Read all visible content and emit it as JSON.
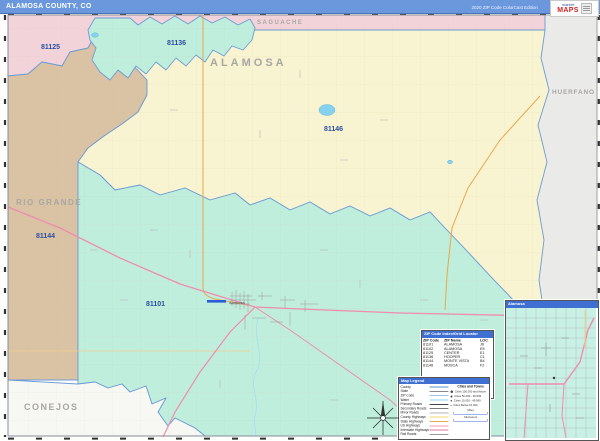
{
  "header": {
    "title": "ALAMOSA COUNTY, CO",
    "edition": "2020 ZIP Code ColorCast Edition",
    "logo": {
      "word1": "market",
      "word2": "MAPS"
    }
  },
  "map": {
    "county_labels": [
      {
        "name": "SAGUACHE"
      },
      {
        "name": "ALAMOSA"
      },
      {
        "name": "RIO GRANDE"
      },
      {
        "name": "CONEJOS"
      },
      {
        "name": "HUERFANO"
      }
    ],
    "zip_labels": [
      {
        "code": "81125"
      },
      {
        "code": "81136"
      },
      {
        "code": "81146"
      },
      {
        "code": "81144"
      },
      {
        "code": "81101"
      }
    ],
    "city_label": "Alamosa",
    "colors": {
      "zip_teal": "#bfeedd",
      "zip_yellow": "#f8f3d1",
      "zip_pink": "#f3d3da",
      "zip_tan": "#d9c3a4",
      "neighbor_gray": "#eaeae8",
      "boundary_blue": "#6d9bd3",
      "us_highway_pink": "#f08cae",
      "state_highway_orange": "#e8a84c",
      "water_blue": "#86d2ee",
      "header_blue": "#6b97dd",
      "panel_blue": "#3e6fd1"
    }
  },
  "index_table": {
    "title": "ZIP Code Index/Grid Locator",
    "columns": [
      "ZIP Code",
      "ZIP Name",
      "LOC"
    ],
    "rows": [
      {
        "zip": "81101",
        "name": "ALAMOSA",
        "loc": "J6"
      },
      {
        "zip": "81102",
        "name": "ALAMOSA",
        "loc": "E5"
      },
      {
        "zip": "81125",
        "name": "CENTER",
        "loc": "E1"
      },
      {
        "zip": "81136",
        "name": "HOOPER",
        "loc": "C1"
      },
      {
        "zip": "81144",
        "name": "MONTE VISTA",
        "loc": "B4"
      },
      {
        "zip": "81146",
        "name": "MOSCA",
        "loc": "F2"
      }
    ]
  },
  "legend": {
    "title": "Map Legend",
    "line_items": [
      {
        "label": "County",
        "color": "#5b8fd0"
      },
      {
        "label": "State",
        "color": "#8a8a8a"
      },
      {
        "label": "ZIP Code",
        "color": "#9fc4e8"
      },
      {
        "label": "Water",
        "color": "#8fd6f0"
      },
      {
        "label": "Primary Roads",
        "color": "#444444"
      },
      {
        "label": "Secondary Roads",
        "color": "#7a7a7a"
      },
      {
        "label": "Minor Roads",
        "color": "#b5b5b5"
      },
      {
        "label": "County Highways",
        "color": "#f5d46a"
      },
      {
        "label": "State Highways",
        "color": "#e8a84c"
      },
      {
        "label": "US Highways",
        "color": "#f59ab4"
      },
      {
        "label": "Interstate Highways",
        "color": "#e86ca0"
      },
      {
        "label": "Rail Roads",
        "color": "#999999"
      }
    ],
    "cities_title": "Cities and Towns",
    "city_items": [
      {
        "label": "Cities 100,000 and Above"
      },
      {
        "label": "Cities 50,000 - 99,999"
      },
      {
        "label": "Cities 10,000 - 49,999"
      },
      {
        "label": "Cities Below 10,000"
      }
    ],
    "scale_labels": [
      "Miles",
      "Kilometers"
    ]
  },
  "inset": {
    "title": "Alamosa"
  }
}
